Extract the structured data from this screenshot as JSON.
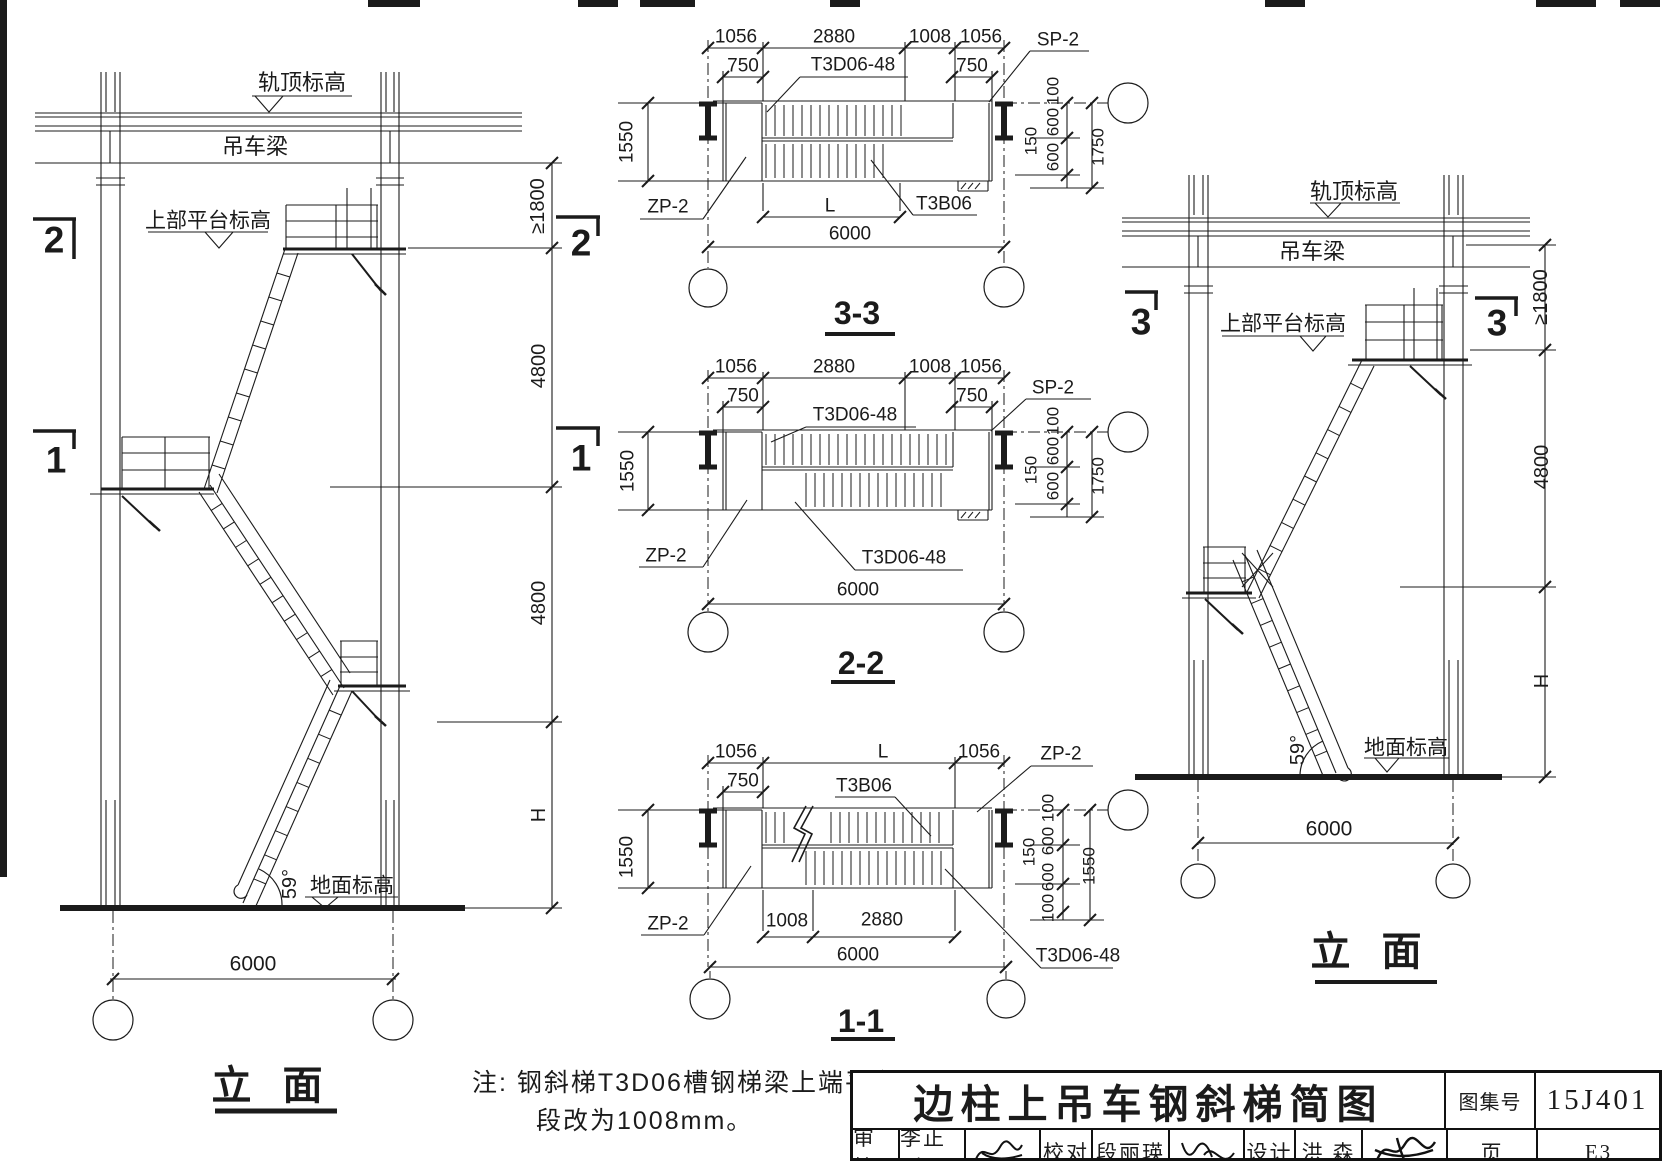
{
  "page": {
    "background": "#ffffff",
    "ink": "#1b1b1b"
  },
  "note": {
    "prefix": "注:",
    "line1": "钢斜梯T3D06槽钢梯梁上端平台",
    "line2": "段改为1008mm。"
  },
  "title_block": {
    "title": "边柱上吊车钢斜梯简图",
    "atlas_label": "图集号",
    "atlas_no": "15J401",
    "page_label": "页",
    "page_no": "E3",
    "review_label": "审核",
    "reviewer": "李正刚",
    "check_label": "校对",
    "checker": "段丽瑛",
    "design_label": "设计",
    "designer": "洪  森"
  },
  "annotations": [
    {
      "n": "rail-top-elevation-label",
      "t": "轨顶标高",
      "x": 302,
      "y": 83,
      "fs": 22
    },
    {
      "n": "crane-beam-label",
      "t": "吊车梁",
      "x": 255,
      "y": 147,
      "fs": 22
    },
    {
      "n": "upper-platform-elevation-label",
      "t": "上部平台标高",
      "x": 208,
      "y": 221,
      "fs": 21
    },
    {
      "n": "section-mark-2-left",
      "t": "2",
      "x": 54,
      "y": 240,
      "fs": 37,
      "b": 1
    },
    {
      "n": "section-mark-2-right",
      "t": "2",
      "x": 581,
      "y": 243,
      "fs": 37,
      "b": 1
    },
    {
      "n": "section-mark-1-left",
      "t": "1",
      "x": 56,
      "y": 460,
      "fs": 37,
      "b": 1
    },
    {
      "n": "section-mark-1-right",
      "t": "1",
      "x": 581,
      "y": 458,
      "fs": 37,
      "b": 1
    },
    {
      "n": "dim-ge1800",
      "t": "≥1800",
      "x": 538,
      "y": 206,
      "fs": 20,
      "r": 1
    },
    {
      "n": "dim-4800",
      "t": "4800",
      "x": 539,
      "y": 366,
      "fs": 20,
      "r": 1
    },
    {
      "n": "dim-4800",
      "t": "4800",
      "x": 539,
      "y": 603,
      "fs": 20,
      "r": 1
    },
    {
      "n": "dim-H",
      "t": "H",
      "x": 539,
      "y": 815,
      "fs": 20,
      "r": 1
    },
    {
      "n": "angle-59deg",
      "t": "59°",
      "x": 290,
      "y": 884,
      "fs": 20,
      "r": 1
    },
    {
      "n": "ground-elevation-label",
      "t": "地面标高",
      "x": 352,
      "y": 886,
      "fs": 21
    },
    {
      "n": "dim-6000",
      "t": "6000",
      "x": 253,
      "y": 964,
      "fs": 21
    },
    {
      "n": "left-elevation-title",
      "t": "立 面",
      "x": 272,
      "y": 1086,
      "fs": 40,
      "b": 1
    },
    {
      "n": "dim-1056",
      "t": "1056",
      "x": 736,
      "y": 37,
      "fs": 19
    },
    {
      "n": "dim-2880",
      "t": "2880",
      "x": 834,
      "y": 37,
      "fs": 19
    },
    {
      "n": "dim-1008",
      "t": "1008",
      "x": 930,
      "y": 37,
      "fs": 19
    },
    {
      "n": "dim-1056",
      "t": "1056",
      "x": 981,
      "y": 37,
      "fs": 19
    },
    {
      "n": "dim-750",
      "t": "750",
      "x": 743,
      "y": 66,
      "fs": 19
    },
    {
      "n": "dim-750",
      "t": "750",
      "x": 972,
      "y": 66,
      "fs": 19
    },
    {
      "n": "label-T3D06-48",
      "t": "T3D06-48",
      "x": 853,
      "y": 65,
      "fs": 19
    },
    {
      "n": "label-SP-2",
      "t": "SP-2",
      "x": 1058,
      "y": 40,
      "fs": 19
    },
    {
      "n": "label-ZP-2",
      "t": "ZP-2",
      "x": 668,
      "y": 207,
      "fs": 19
    },
    {
      "n": "label-T3B06",
      "t": "T3B06",
      "x": 944,
      "y": 204,
      "fs": 19
    },
    {
      "n": "dim-1550",
      "t": "1550",
      "x": 627,
      "y": 142,
      "fs": 19,
      "r": 1
    },
    {
      "n": "dim-100",
      "t": "100",
      "x": 1053,
      "y": 91,
      "fs": 17,
      "r": 1
    },
    {
      "n": "dim-600",
      "t": "600",
      "x": 1053,
      "y": 122,
      "fs": 17,
      "r": 1
    },
    {
      "n": "dim-150",
      "t": "150",
      "x": 1031,
      "y": 141,
      "fs": 17,
      "r": 1
    },
    {
      "n": "dim-600",
      "t": "600",
      "x": 1053,
      "y": 157,
      "fs": 17,
      "r": 1
    },
    {
      "n": "dim-1750",
      "t": "1750",
      "x": 1098,
      "y": 147,
      "fs": 17,
      "r": 1
    },
    {
      "n": "dim-L",
      "t": "L",
      "x": 830,
      "y": 206,
      "fs": 19
    },
    {
      "n": "dim-6000",
      "t": "6000",
      "x": 850,
      "y": 234,
      "fs": 19
    },
    {
      "n": "section-3-3-title",
      "t": "3-3",
      "x": 857,
      "y": 313,
      "fs": 32,
      "b": 1
    },
    {
      "n": "dim-1056",
      "t": "1056",
      "x": 736,
      "y": 367,
      "fs": 19
    },
    {
      "n": "dim-2880",
      "t": "2880",
      "x": 834,
      "y": 367,
      "fs": 19
    },
    {
      "n": "dim-1008",
      "t": "1008",
      "x": 930,
      "y": 367,
      "fs": 19
    },
    {
      "n": "dim-1056",
      "t": "1056",
      "x": 981,
      "y": 367,
      "fs": 19
    },
    {
      "n": "dim-750",
      "t": "750",
      "x": 743,
      "y": 396,
      "fs": 19
    },
    {
      "n": "dim-750",
      "t": "750",
      "x": 972,
      "y": 396,
      "fs": 19
    },
    {
      "n": "label-T3D06-48",
      "t": "T3D06-48",
      "x": 855,
      "y": 415,
      "fs": 19
    },
    {
      "n": "label-SP-2",
      "t": "SP-2",
      "x": 1053,
      "y": 388,
      "fs": 19
    },
    {
      "n": "label-ZP-2",
      "t": "ZP-2",
      "x": 666,
      "y": 556,
      "fs": 19
    },
    {
      "n": "label-T3D06-48",
      "t": "T3D06-48",
      "x": 904,
      "y": 558,
      "fs": 19
    },
    {
      "n": "dim-1550",
      "t": "1550",
      "x": 628,
      "y": 471,
      "fs": 19,
      "r": 1
    },
    {
      "n": "dim-100",
      "t": "100",
      "x": 1053,
      "y": 421,
      "fs": 17,
      "r": 1
    },
    {
      "n": "dim-600",
      "t": "600",
      "x": 1053,
      "y": 451,
      "fs": 17,
      "r": 1
    },
    {
      "n": "dim-150",
      "t": "150",
      "x": 1031,
      "y": 470,
      "fs": 17,
      "r": 1
    },
    {
      "n": "dim-600",
      "t": "600",
      "x": 1053,
      "y": 486,
      "fs": 17,
      "r": 1
    },
    {
      "n": "dim-1750",
      "t": "1750",
      "x": 1098,
      "y": 476,
      "fs": 17,
      "r": 1
    },
    {
      "n": "dim-6000",
      "t": "6000",
      "x": 858,
      "y": 590,
      "fs": 19
    },
    {
      "n": "section-2-2-title",
      "t": "2-2",
      "x": 861,
      "y": 663,
      "fs": 32,
      "b": 1
    },
    {
      "n": "dim-1056",
      "t": "1056",
      "x": 736,
      "y": 752,
      "fs": 19
    },
    {
      "n": "dim-L",
      "t": "L",
      "x": 883,
      "y": 752,
      "fs": 19
    },
    {
      "n": "dim-1056",
      "t": "1056",
      "x": 979,
      "y": 752,
      "fs": 19
    },
    {
      "n": "dim-750",
      "t": "750",
      "x": 743,
      "y": 781,
      "fs": 19
    },
    {
      "n": "label-T3B06",
      "t": "T3B06",
      "x": 864,
      "y": 786,
      "fs": 19
    },
    {
      "n": "label-ZP-2",
      "t": "ZP-2",
      "x": 1061,
      "y": 754,
      "fs": 19
    },
    {
      "n": "label-ZP-2",
      "t": "ZP-2",
      "x": 668,
      "y": 924,
      "fs": 19
    },
    {
      "n": "dim-1550",
      "t": "1550",
      "x": 627,
      "y": 857,
      "fs": 19,
      "r": 1
    },
    {
      "n": "dim-100",
      "t": "100",
      "x": 1048,
      "y": 808,
      "fs": 17,
      "r": 1
    },
    {
      "n": "dim-600",
      "t": "600",
      "x": 1048,
      "y": 841,
      "fs": 17,
      "r": 1
    },
    {
      "n": "dim-150",
      "t": "150",
      "x": 1029,
      "y": 852,
      "fs": 17,
      "r": 1
    },
    {
      "n": "dim-600",
      "t": "600",
      "x": 1048,
      "y": 877,
      "fs": 17,
      "r": 1
    },
    {
      "n": "dim-100",
      "t": "100",
      "x": 1048,
      "y": 908,
      "fs": 17,
      "r": 1
    },
    {
      "n": "dim-1550",
      "t": "1550",
      "x": 1089,
      "y": 866,
      "fs": 17,
      "r": 1
    },
    {
      "n": "dim-1008",
      "t": "1008",
      "x": 787,
      "y": 921,
      "fs": 19
    },
    {
      "n": "dim-2880",
      "t": "2880",
      "x": 882,
      "y": 920,
      "fs": 19
    },
    {
      "n": "dim-6000",
      "t": "6000",
      "x": 858,
      "y": 955,
      "fs": 19
    },
    {
      "n": "label-T3D06-48",
      "t": "T3D06-48",
      "x": 1078,
      "y": 956,
      "fs": 19
    },
    {
      "n": "section-1-1-title",
      "t": "1-1",
      "x": 861,
      "y": 1021,
      "fs": 32,
      "b": 1
    },
    {
      "n": "rail-top-elevation-label",
      "t": "轨顶标高",
      "x": 1354,
      "y": 192,
      "fs": 22
    },
    {
      "n": "crane-beam-label",
      "t": "吊车梁",
      "x": 1312,
      "y": 252,
      "fs": 22
    },
    {
      "n": "upper-platform-elevation-label",
      "t": "上部平台标高",
      "x": 1283,
      "y": 324,
      "fs": 21
    },
    {
      "n": "section-mark-3-left",
      "t": "3",
      "x": 1141,
      "y": 322,
      "fs": 37,
      "b": 1
    },
    {
      "n": "section-mark-3-right",
      "t": "3",
      "x": 1497,
      "y": 323,
      "fs": 37,
      "b": 1
    },
    {
      "n": "dim-ge1800",
      "t": "≥1800",
      "x": 1541,
      "y": 297,
      "fs": 20,
      "r": 1
    },
    {
      "n": "dim-4800",
      "t": "4800",
      "x": 1542,
      "y": 467,
      "fs": 20,
      "r": 1
    },
    {
      "n": "dim-H",
      "t": "H",
      "x": 1542,
      "y": 681,
      "fs": 20,
      "r": 1
    },
    {
      "n": "angle-59deg",
      "t": "59°",
      "x": 1298,
      "y": 750,
      "fs": 20,
      "r": 1
    },
    {
      "n": "ground-elevation-label",
      "t": "地面标高",
      "x": 1406,
      "y": 748,
      "fs": 21
    },
    {
      "n": "dim-6000",
      "t": "6000",
      "x": 1329,
      "y": 829,
      "fs": 21
    },
    {
      "n": "right-elevation-title",
      "t": "立 面",
      "x": 1371,
      "y": 952,
      "fs": 40,
      "b": 1
    }
  ]
}
